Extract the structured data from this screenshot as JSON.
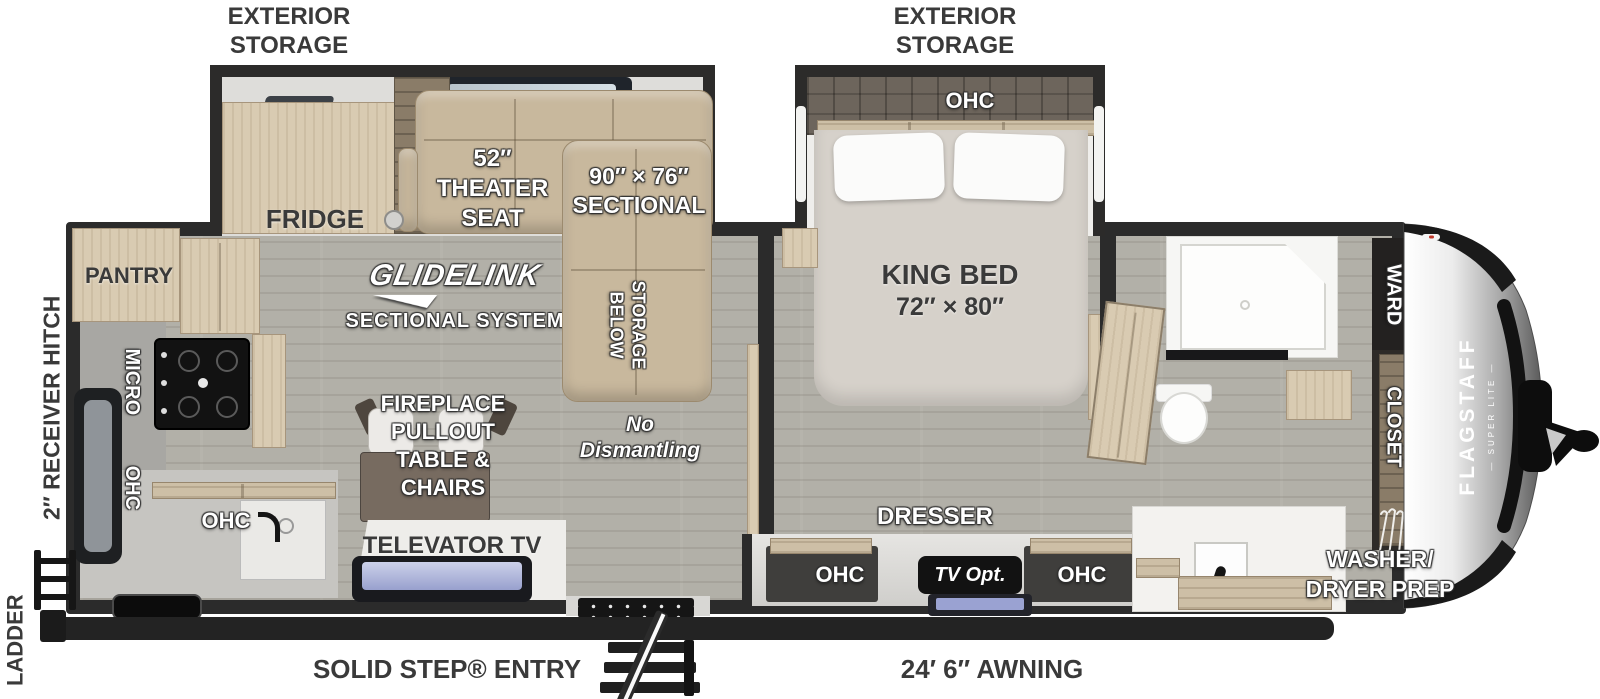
{
  "title": "Flagstaff Super Lite travel trailer floor plan",
  "labels": {
    "exterior_storage_l1": "EXTERIOR",
    "exterior_storage_l2": "STORAGE",
    "fridge": "FRIDGE",
    "pantry": "PANTRY",
    "micro": "MICRO",
    "ohc": "OHC",
    "theater_l1": "52″",
    "theater_l2": "THEATER",
    "theater_l3": "SEAT",
    "sectional_l1": "90″ × 76″",
    "sectional_l2": "SECTIONAL",
    "glidelink": "GLIDELINK",
    "glidelink_sub": "SECTIONAL SYSTEM",
    "storage_below_l1": "STORAGE",
    "storage_below_l2": "BELOW",
    "no_dismantling_l1": "No",
    "no_dismantling_l2": "Dismantling",
    "fireplace_l1": "FIREPLACE",
    "fireplace_l2": "PULLOUT",
    "fireplace_l3": "TABLE &",
    "fireplace_l4": "CHAIRS",
    "televator": "TELEVATOR TV",
    "king_bed_l1": "KING BED",
    "king_bed_l2": "72″ × 80″",
    "dresser": "DRESSER",
    "tv_opt": "TV Opt.",
    "ward": "WARD",
    "closet": "CLOSET",
    "washer_dryer_l1": "WASHER/",
    "washer_dryer_l2": "DRYER PREP",
    "flagstaff": "FLAGSTAFF",
    "super_lite": "— SUPER LITE —",
    "ladder": "LADDER",
    "receiver_hitch": "2″ RECEIVER HITCH",
    "solid_step": "SOLID STEP® ENTRY",
    "awning": "24′ 6″ AWNING"
  },
  "colors": {
    "wall": "#2b2b2b",
    "floor": "#b2b0a8",
    "wood": "#d9cbb2",
    "sofa_tan": "#c8b89d",
    "slide_floor_dark": "#6d655c",
    "badge_black": "#121212",
    "text_dark": "#3a3a3a",
    "screen_lavender": "#aab1dd",
    "cap_silver": "#c9c9c9"
  }
}
